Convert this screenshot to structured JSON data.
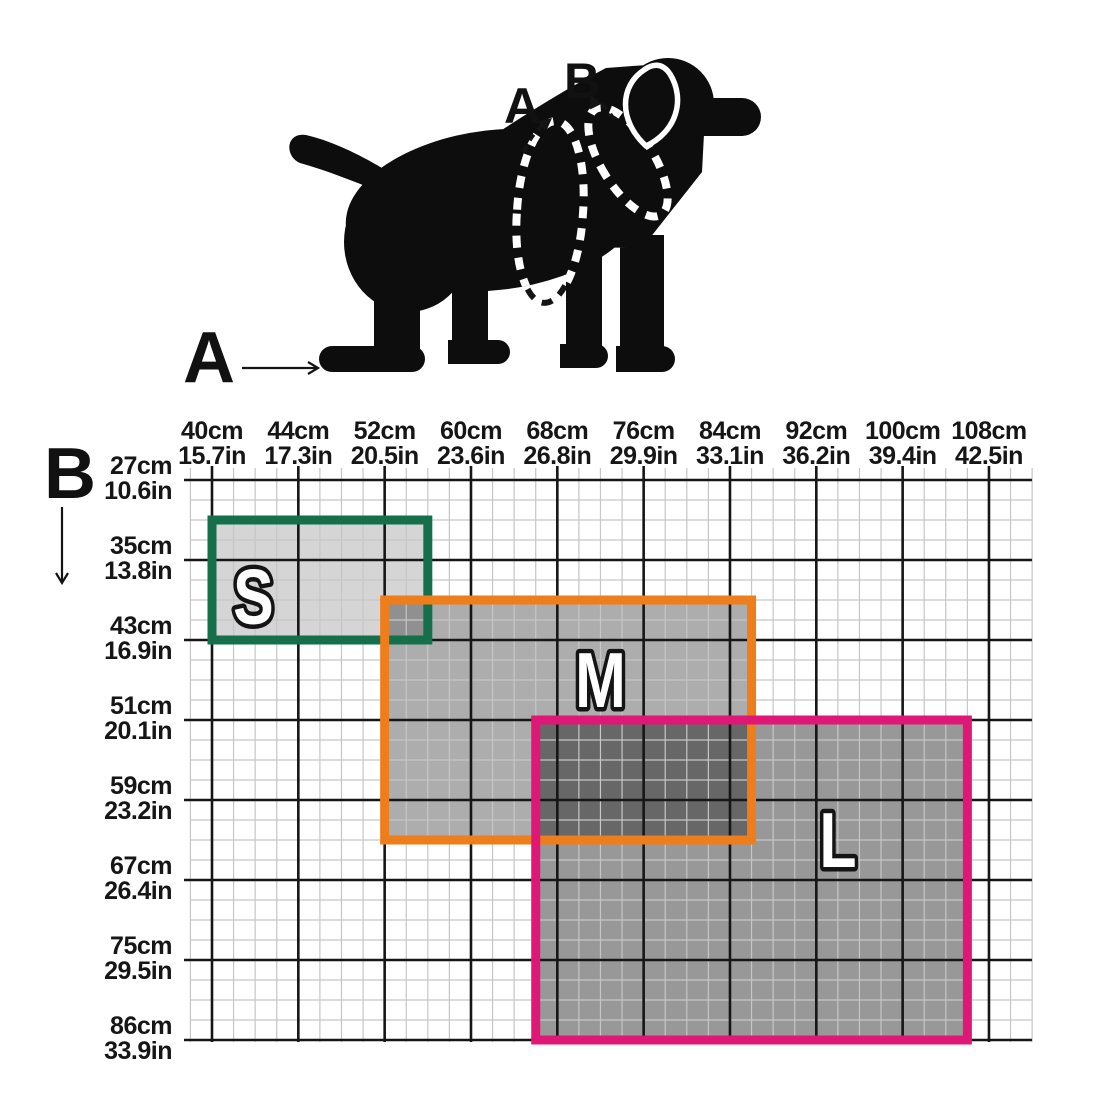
{
  "figure": {
    "dog_markers": {
      "a": "A",
      "b": "B"
    }
  },
  "chart_data": {
    "type": "heatmap",
    "title": "Dog harness size chart (S / M / L zones on measurement grid)",
    "description": "A = girth measured around the chest behind the front legs (x-axis); B = girth measured around the neck/chest over the shoulders (y-axis). Overlapping shaded rectangles show which size fits each combination of measurements.",
    "x_axis": {
      "label": "A",
      "ticks": [
        {
          "cm": "40cm",
          "in": "15.7in"
        },
        {
          "cm": "44cm",
          "in": "17.3in"
        },
        {
          "cm": "52cm",
          "in": "20.5in"
        },
        {
          "cm": "60cm",
          "in": "23.6in"
        },
        {
          "cm": "68cm",
          "in": "26.8in"
        },
        {
          "cm": "76cm",
          "in": "29.9in"
        },
        {
          "cm": "84cm",
          "in": "33.1in"
        },
        {
          "cm": "92cm",
          "in": "36.2in"
        },
        {
          "cm": "100cm",
          "in": "39.4in"
        },
        {
          "cm": "108cm",
          "in": "42.5in"
        }
      ]
    },
    "y_axis": {
      "label": "B",
      "ticks": [
        {
          "cm": "27cm",
          "in": "10.6in"
        },
        {
          "cm": "35cm",
          "in": "13.8in"
        },
        {
          "cm": "43cm",
          "in": "16.9in"
        },
        {
          "cm": "51cm",
          "in": "20.1in"
        },
        {
          "cm": "59cm",
          "in": "23.2in"
        },
        {
          "cm": "67cm",
          "in": "26.4in"
        },
        {
          "cm": "75cm",
          "in": "29.5in"
        },
        {
          "cm": "86cm",
          "in": "33.9in"
        }
      ]
    },
    "zones": [
      {
        "label": "S",
        "color": "#146f4a",
        "fill_opacity": 0.165,
        "col_start": 0,
        "col_end": 2.5,
        "row_start": 0.5,
        "row_end": 2,
        "label_col": 0.48,
        "label_row": 1.46,
        "a_range_cm_approx": [
          40,
          56
        ],
        "b_range_cm_approx": [
          31,
          43
        ]
      },
      {
        "label": "M",
        "color": "#ee7d1c",
        "fill_opacity": 0.32,
        "col_start": 2,
        "col_end": 6.25,
        "row_start": 1.5,
        "row_end": 4.5,
        "label_col": 4.5,
        "label_row": 2.5,
        "a_range_cm_approx": [
          52,
          78
        ],
        "b_range_cm_approx": [
          39,
          63
        ]
      },
      {
        "label": "L",
        "color": "#df1878",
        "fill_opacity": 0.405,
        "col_start": 3.75,
        "col_end": 8.75,
        "row_start": 3,
        "row_end": 7,
        "label_col": 7.25,
        "label_row": 4.5,
        "a_range_cm_approx": [
          66,
          106
        ],
        "b_range_cm_approx": [
          51,
          86
        ]
      }
    ],
    "grid": {
      "minor_per_major": 4,
      "minor_line_color": "#c6c6c6",
      "major_line_color": "#161616",
      "legend": "none"
    }
  }
}
